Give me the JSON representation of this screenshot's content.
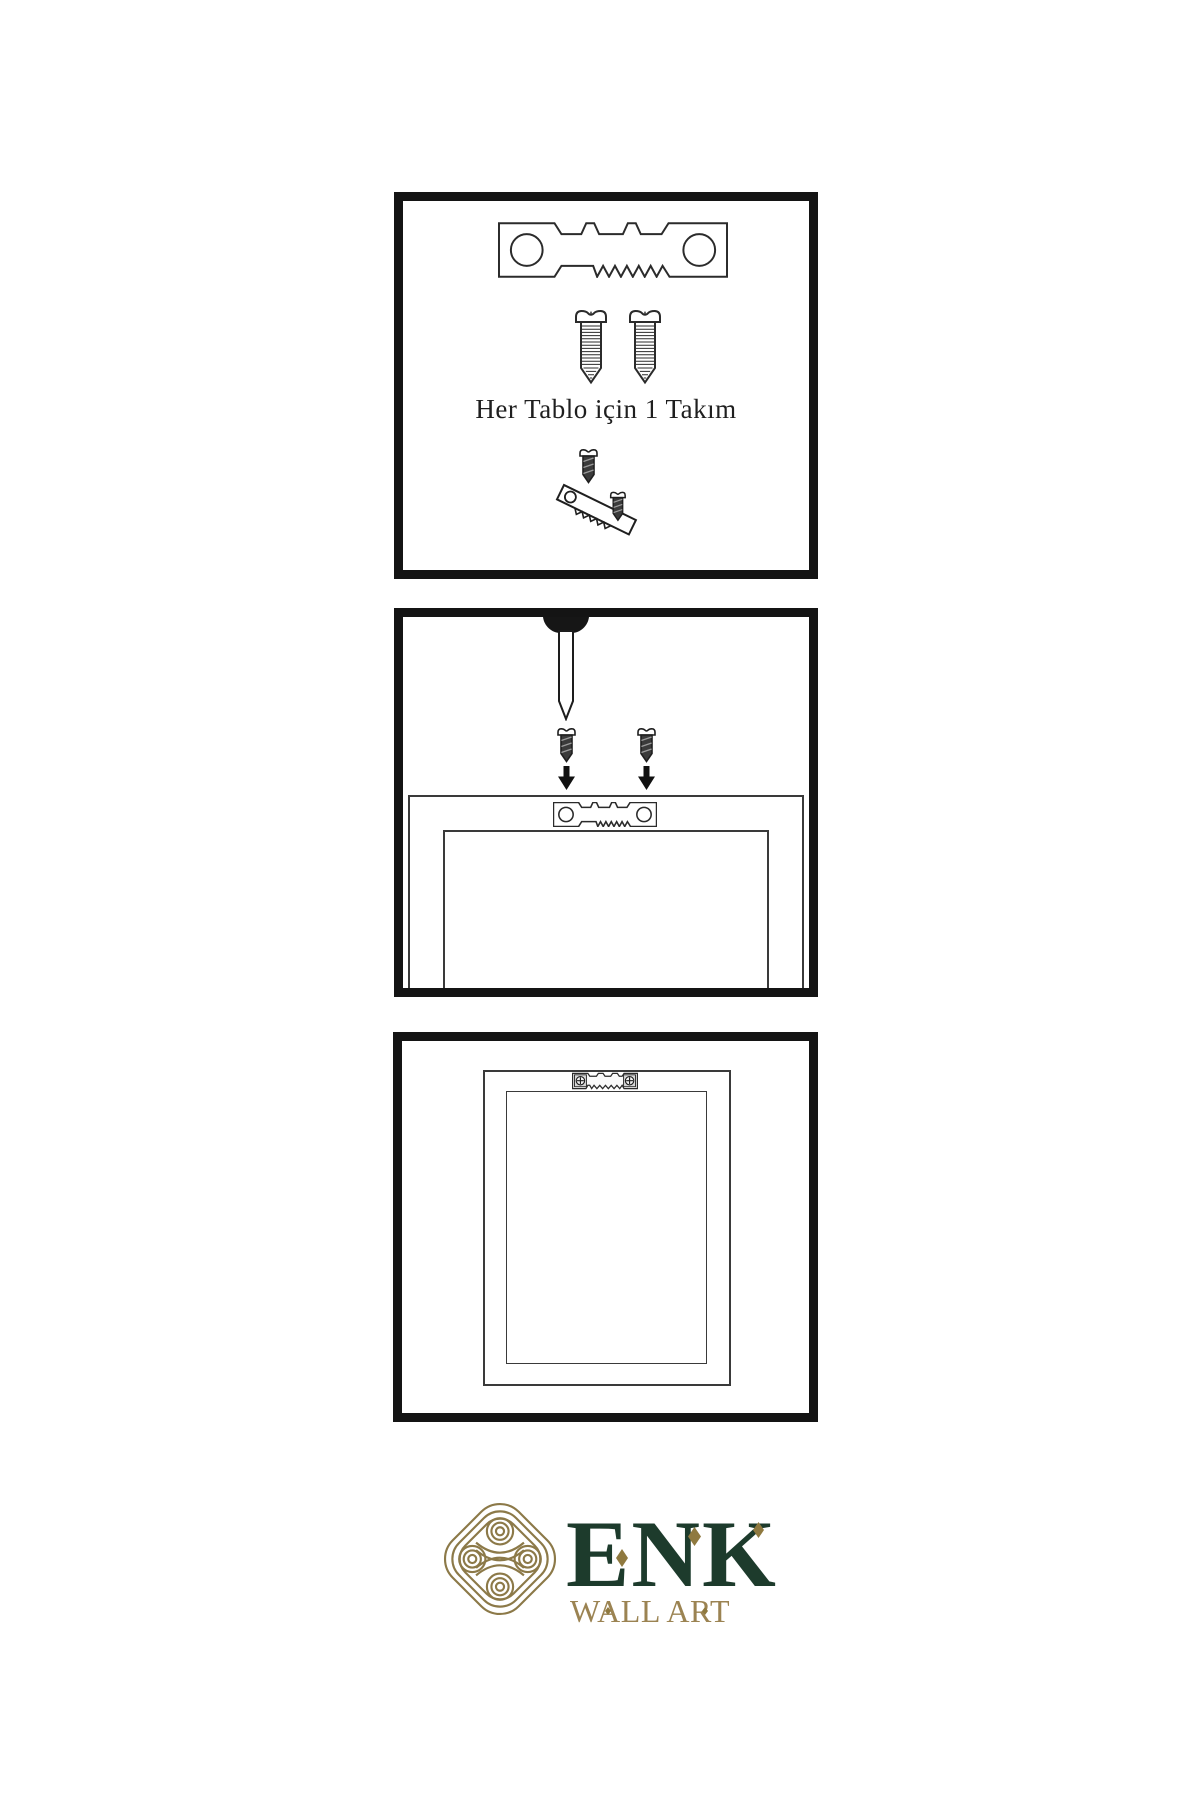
{
  "canvas": {
    "width": 1200,
    "height": 1800,
    "background": "#ffffff"
  },
  "style": {
    "panel_border_color": "#141414",
    "line_color": "#2b2b2b",
    "dark_screw_fill": "#3b3b3b",
    "frame_line_color": "#3a3a3a"
  },
  "kit_panel": {
    "caption": "Her Tablo için 1 Takım",
    "icons": [
      "sawtooth-hanger-icon",
      "screw-icon",
      "screw-icon",
      "screw-into-hanger-icon"
    ]
  },
  "nail_panel": {
    "icons": [
      "wall-nail-icon",
      "screw-icon",
      "screw-icon",
      "down-arrow-icon",
      "down-arrow-icon",
      "frame-back-icon",
      "sawtooth-hanger-icon"
    ]
  },
  "hang_panel": {
    "icons": [
      "framed-picture-icon",
      "mounted-sawtooth-hanger-icon"
    ]
  },
  "brand": {
    "name": "ENK",
    "tagline": "WALL ART",
    "logo_icon": "knot-logo-icon",
    "colors": {
      "name": "#1d3b2c",
      "tagline": "#9b8352",
      "logo": "#8c7948",
      "diamond": "#8f793f"
    }
  }
}
